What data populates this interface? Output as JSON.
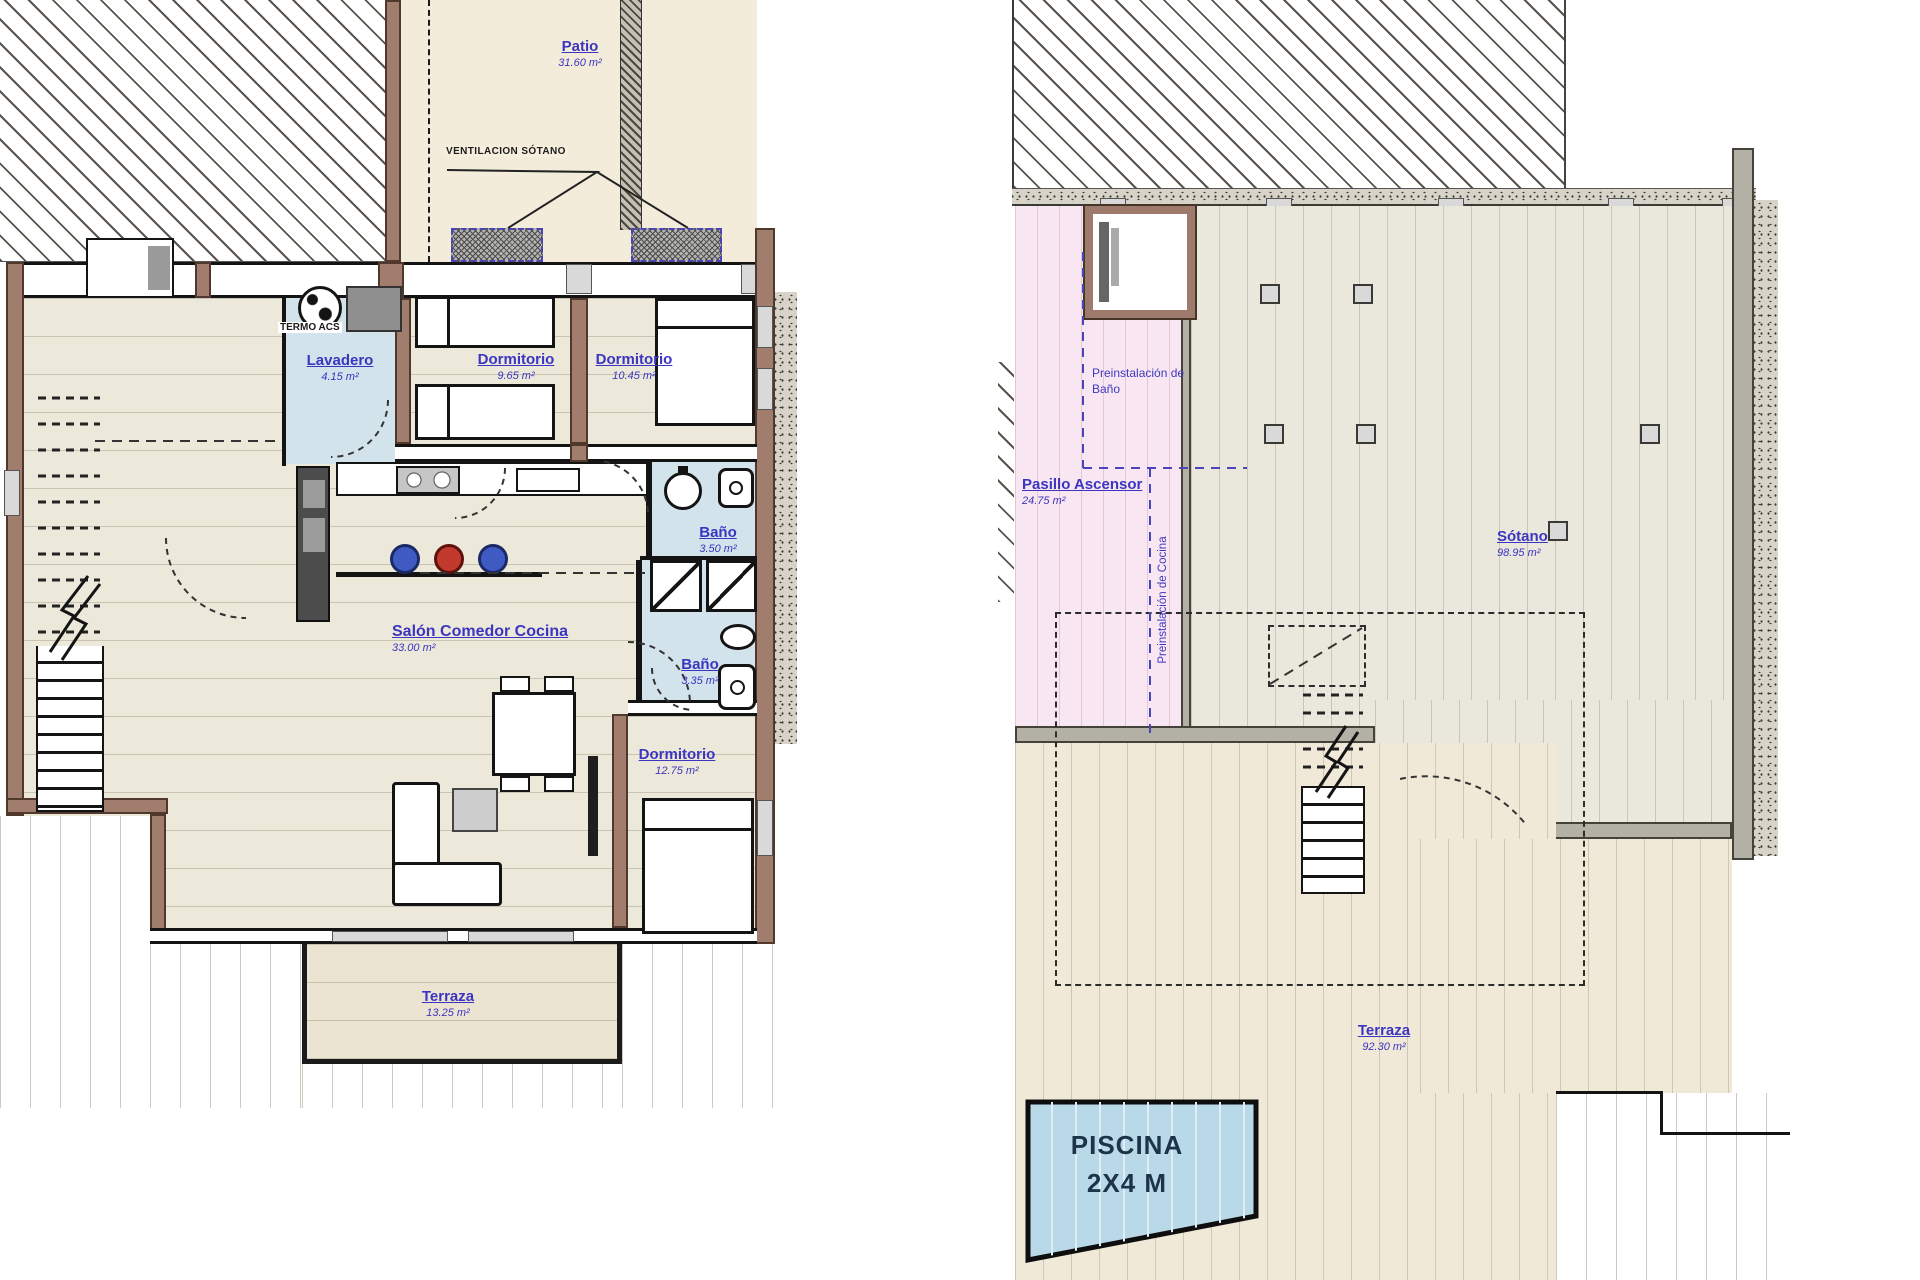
{
  "plan_left": {
    "patio": {
      "name": "Patio",
      "area": "31.60 m²"
    },
    "ventilacion": "VENTILACION SÓTANO",
    "termo": "TERMO ACS",
    "lavadero": {
      "name": "Lavadero",
      "area": "4.15 m²"
    },
    "dorm1": {
      "name": "Dormitorio",
      "area": "9.65 m²"
    },
    "dorm2": {
      "name": "Dormitorio",
      "area": "10.45 m²"
    },
    "bano1": {
      "name": "Baño",
      "area": "3.50 m²"
    },
    "salon": {
      "name": "Salón Comedor Cocina",
      "area": "33.00 m²"
    },
    "bano2": {
      "name": "Baño",
      "area": "3.35 m²"
    },
    "dorm3": {
      "name": "Dormitorio",
      "area": "12.75 m²"
    },
    "terraza": {
      "name": "Terraza",
      "area": "13.25 m²"
    }
  },
  "plan_right": {
    "pre_bano": "Preinstalación de Baño",
    "pasillo": {
      "name": "Pasillo Ascensor",
      "area": "24.75 m²"
    },
    "pre_cocina": "Preinstalación de Cocina",
    "sotano": {
      "name": "Sótano",
      "area": "98.95 m²"
    },
    "terraza": {
      "name": "Terraza",
      "area": "92.30 m²"
    },
    "piscina": {
      "line1": "PISCINA",
      "line2": "2X4 M"
    }
  },
  "colors": {
    "label_blue": "#3c35c0",
    "wall_brown": "#a17d6d",
    "bath_blue": "#d3e3ec",
    "pool_blue": "#b9d9e9",
    "preinstall_pink": "#f8e7f2",
    "patio_beige": "#f3ecdb"
  }
}
